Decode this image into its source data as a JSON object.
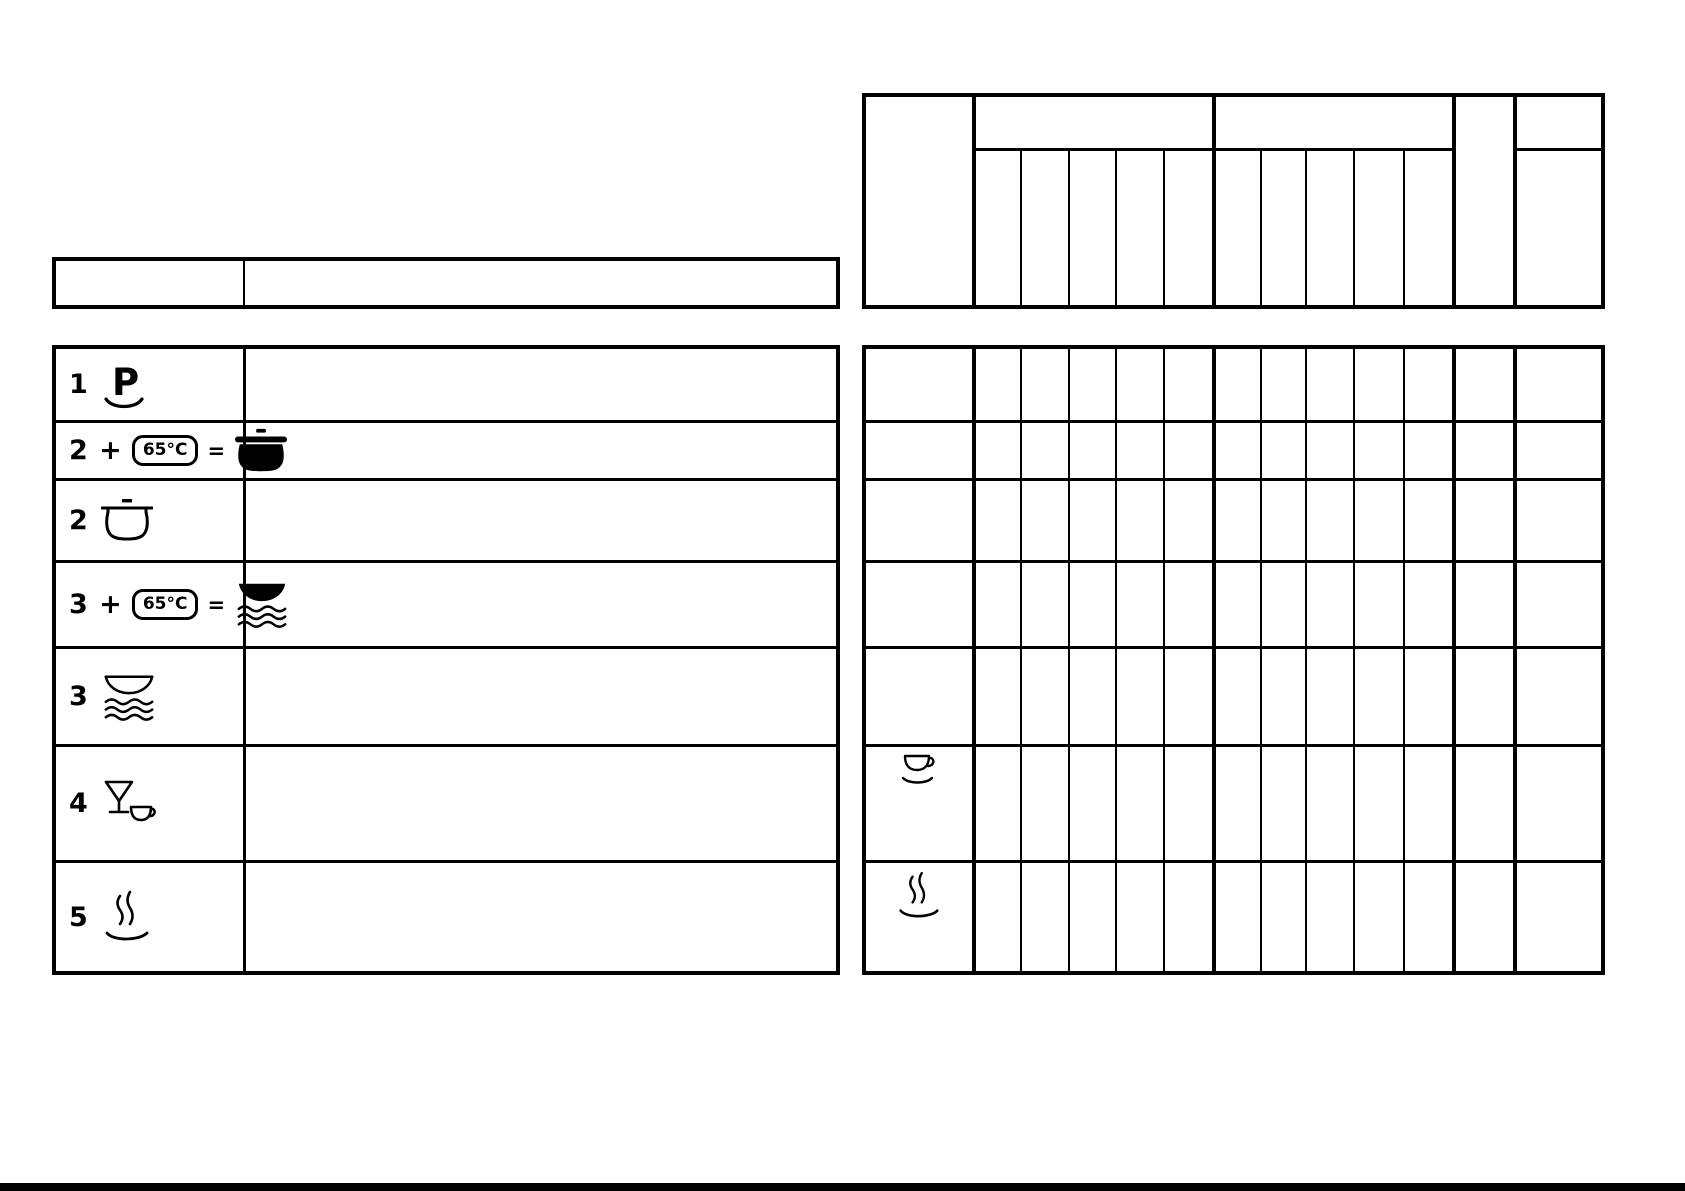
{
  "palette": {
    "ink": "#000000",
    "paper": "#ffffff"
  },
  "legend_table": {
    "rows": [
      {
        "label": "1",
        "icon": "plate-p"
      },
      {
        "label": "2 +",
        "badge": "65°C",
        "equals": "=",
        "icon": "pot-filled"
      },
      {
        "label": "2",
        "icon": "pot-outline"
      },
      {
        "label": "3 +",
        "badge": "65°C",
        "equals": "=",
        "icon": "plates-filled"
      },
      {
        "label": "3",
        "icon": "plates-outline"
      },
      {
        "label": "4",
        "icon": "glass-and-cup"
      },
      {
        "label": "5",
        "icon": "steam-dish"
      }
    ]
  },
  "program_grid": {
    "row_icons": [
      {
        "row": 6,
        "icon": "cup-saucer"
      },
      {
        "row": 7,
        "icon": "steam-dish"
      }
    ]
  }
}
